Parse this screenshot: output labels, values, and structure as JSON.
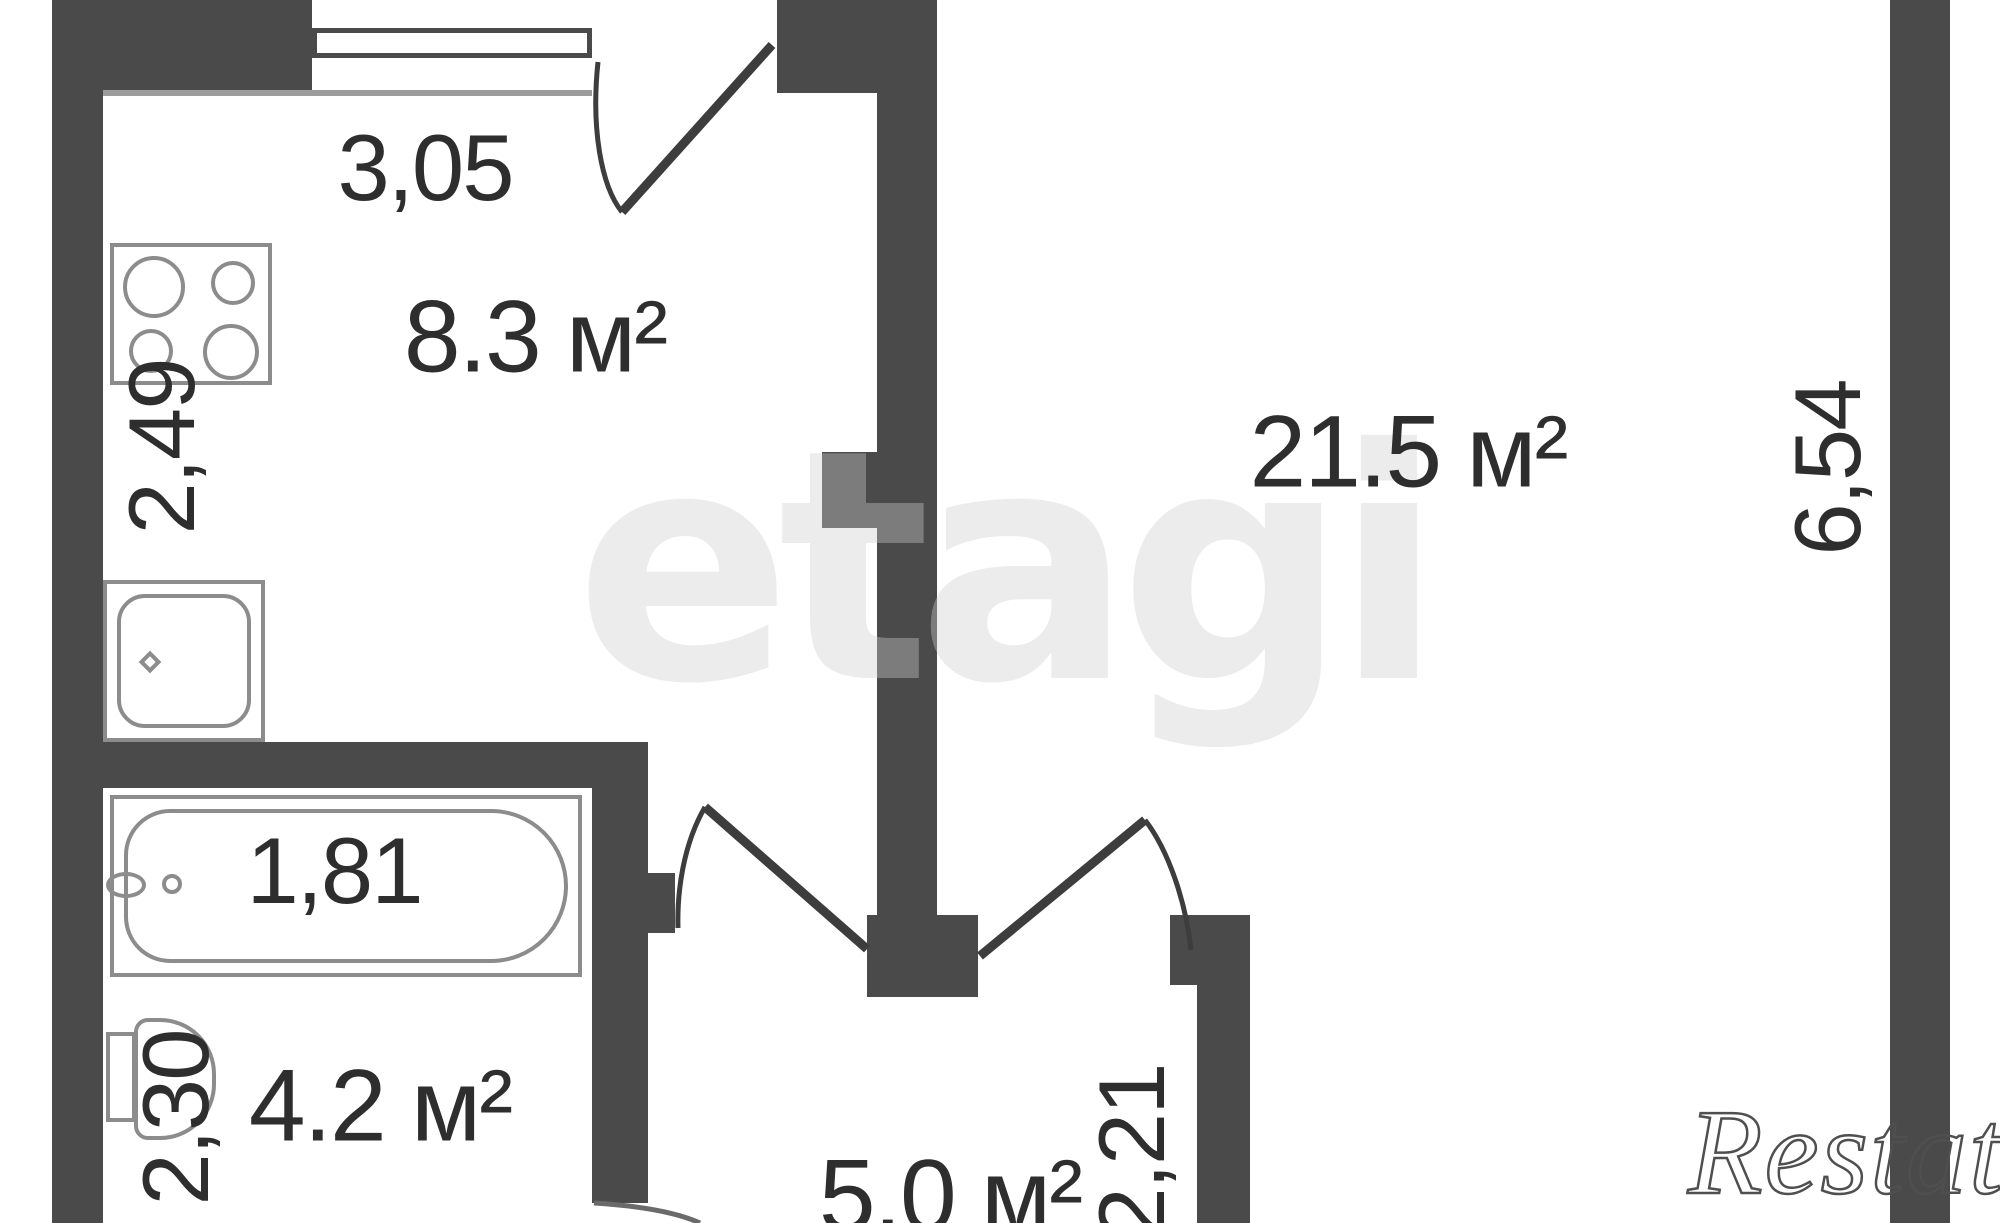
{
  "watermarks": {
    "center": "etagi",
    "brand": "Restate"
  },
  "labels": {
    "kitchen_width": "3,05",
    "kitchen_area": "8.3 м²",
    "kitchen_depth": "2,49",
    "living_area": "21.5 м²",
    "living_depth": "6,54",
    "tub_length": "1,81",
    "bath_area": "4.2 м²",
    "bath_depth": "2,30",
    "hall_area": "5.0 м²",
    "hall_width": "2,21"
  },
  "colors": {
    "wall": "#4a4a4a",
    "fixture_outline": "#8c8c8c",
    "text": "#2e2e2e"
  }
}
